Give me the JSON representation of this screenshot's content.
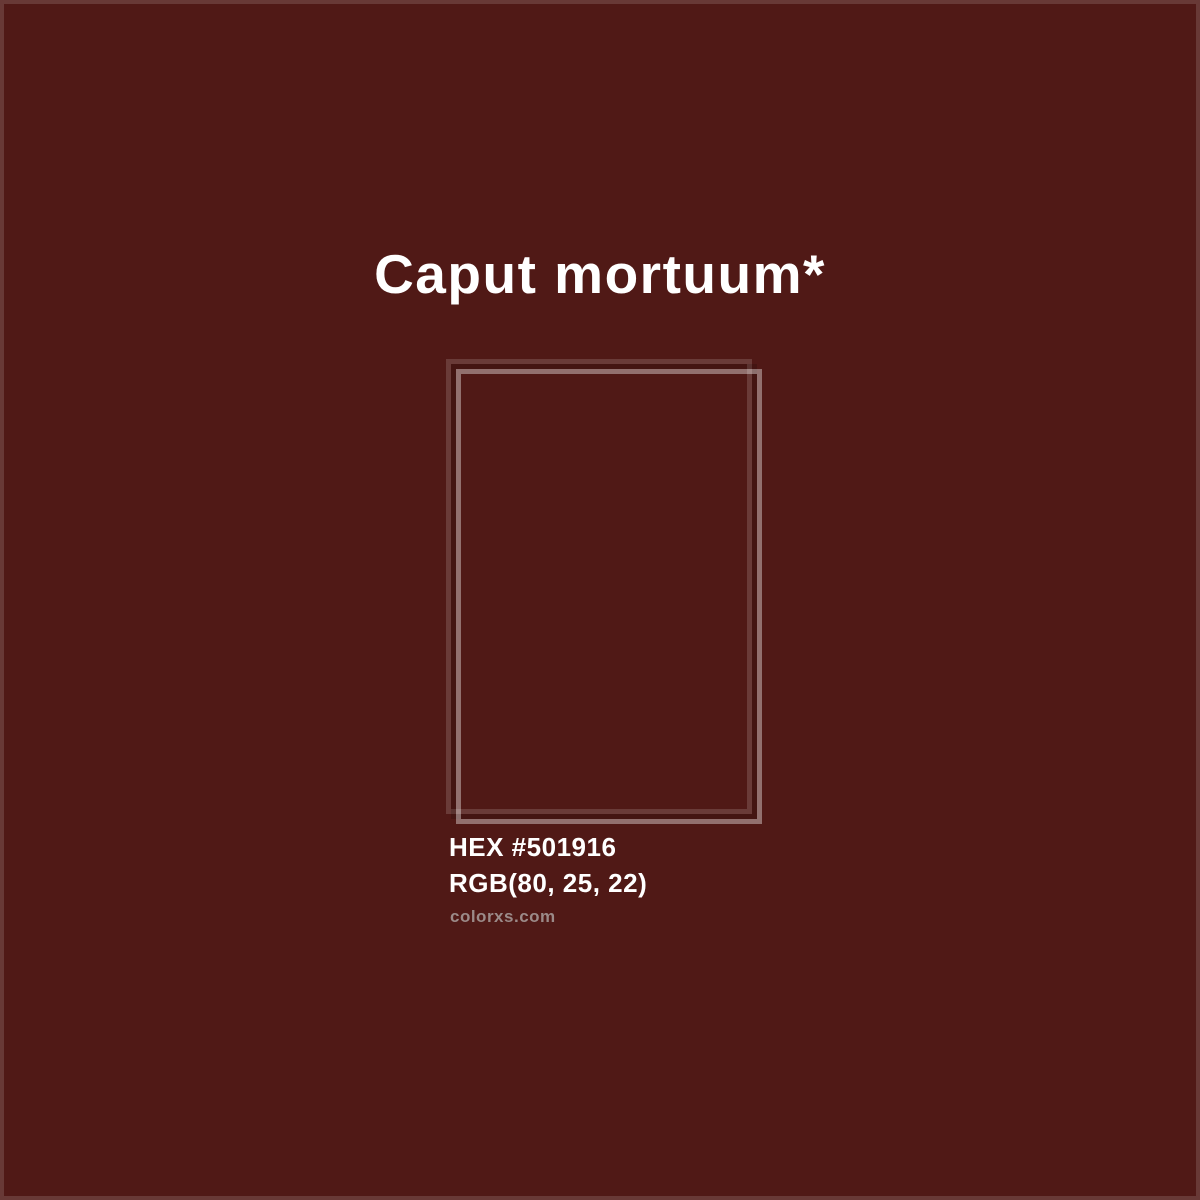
{
  "page": {
    "title": "Caput mortuum*",
    "hex_label": "HEX #501916",
    "rgb_label": "RGB(80, 25, 22)",
    "watermark": "colorxs.com"
  },
  "swatch": {
    "name": "Caput mortuum",
    "hex": "#501916",
    "rgb": [
      80,
      25,
      22
    ]
  },
  "colors": {
    "background": "#501916",
    "title-text": "#FFFFFF",
    "label-text": "#FFFFFF",
    "watermark-text": "#9B8A88",
    "page-border": "#FFFFFF24",
    "frame-dim": "#FFFFFF26",
    "frame-dark": "#00000026",
    "frame-bright": "#FFFFFF61"
  }
}
